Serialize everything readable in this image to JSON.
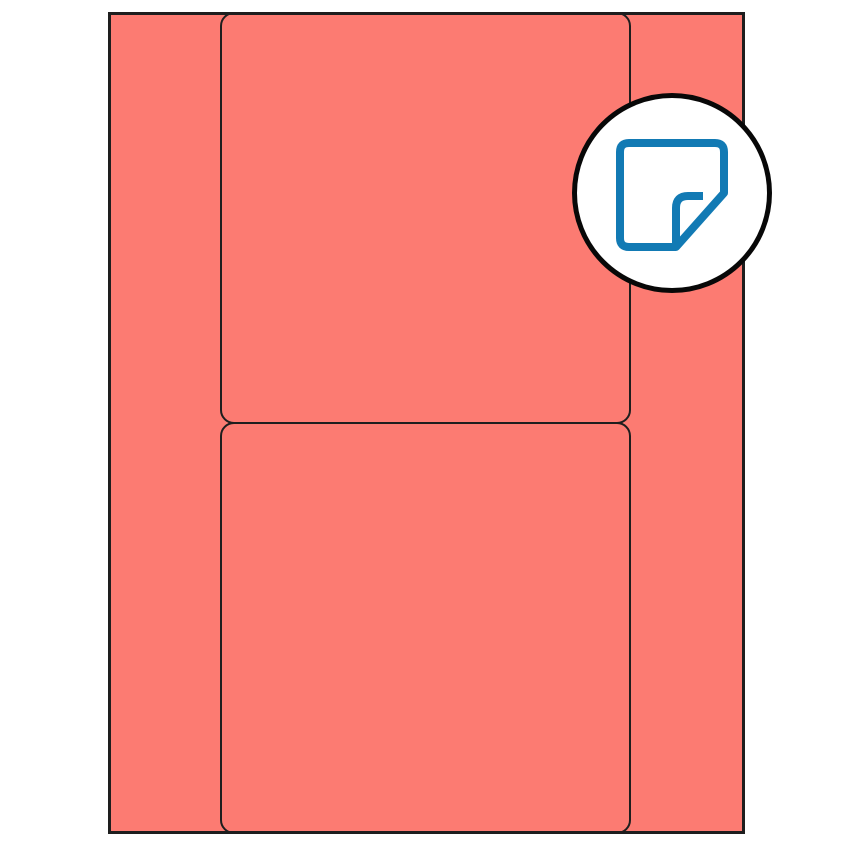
{
  "page": {
    "kind": "label-sheet-template-preview"
  },
  "colors": {
    "background": "#FFFFFF",
    "coral": "#FC7B72",
    "line": "#1E1E1E",
    "badge_border": "#080808",
    "badge_fill": "#FFFFFF",
    "icon_blue": "#127AB4"
  },
  "sheet": {
    "fill": "#FC7B72",
    "border_color": "#1E1E1E"
  },
  "labels": {
    "count": 2,
    "shape": "rounded-rectangle",
    "border_color": "#1E1E1E"
  },
  "badge": {
    "shape": "circle",
    "fill": "#FFFFFF",
    "border_color": "#080808",
    "icon": "sticky-note-icon",
    "icon_color": "#127AB4"
  }
}
